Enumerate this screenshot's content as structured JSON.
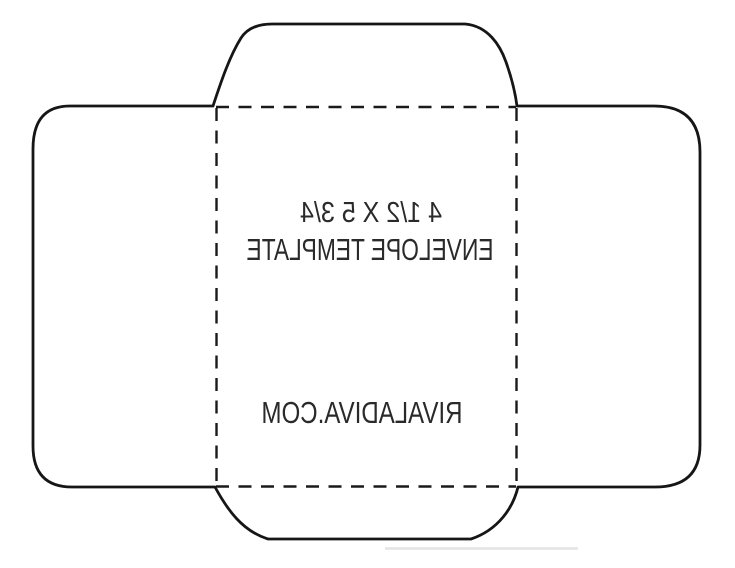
{
  "canvas": {
    "width": "735",
    "height": "568",
    "background": "#ffffff"
  },
  "colors": {
    "cut_line": "#161616",
    "fold_line": "#1a1a1a",
    "text": "#2a2a2a",
    "scan_shadow": "#e0e0e0"
  },
  "envelope": {
    "size_label": "4 1/2 X 5 3/4",
    "type_label": "ENVELOPE TEMPLATE",
    "brand_label": "RIVALADIVA.COM",
    "text_orientation": "mirrored"
  }
}
